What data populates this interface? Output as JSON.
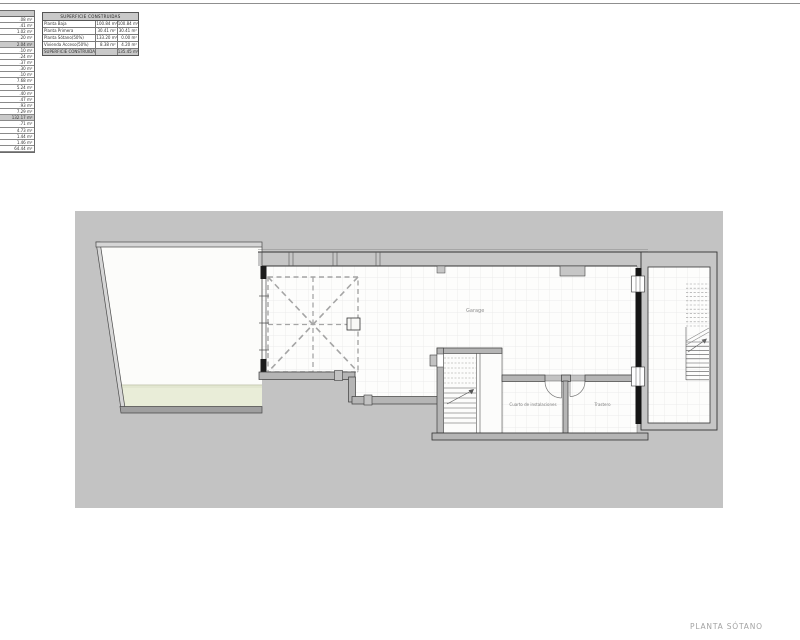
{
  "sheet": {
    "footer_title": "PLANTA SÓTANO"
  },
  "plan_labels": {
    "garage": "Garage",
    "installations_room": "Cuarto de instalaciones",
    "storage_room": "Trastero"
  },
  "colors": {
    "canvas_gray": "#c3c3c3",
    "wall_gray": "#b5b5b5",
    "floor_white": "#fdfdfc",
    "green_strip": "#e9edd8",
    "dashed_gray": "#a5a5a5",
    "black_wall": "#141414",
    "label_gray": "#8f8f8f",
    "footer_gray": "#a3a3a3"
  },
  "tables": {
    "superficie": {
      "header": "SUPERFICIE CONSTRUIDAS",
      "rows": [
        {
          "label": "Planta Baja",
          "col1": "100.84 m²",
          "col2": "100.84 m²",
          "highlight": false
        },
        {
          "label": "Planta Primera",
          "col1": "30.41 m²",
          "col2": "30.41 m²",
          "highlight": false
        },
        {
          "label": "Planta Sótano(50%)",
          "col1": "133.20 m²",
          "col2": "0.00 m²",
          "highlight": false
        },
        {
          "label": "Vivienda Acceso(50%)",
          "col1": "8.38 m²",
          "col2": "4.20 m²",
          "highlight": false
        },
        {
          "label": "SUPERFICIE CONSTRUIDA COMPUTABLE",
          "col1": "",
          "col2": "135.45 m²",
          "highlight": true
        }
      ]
    },
    "left_partial": {
      "rows": [
        {
          "value": ".08 m²",
          "highlight": false
        },
        {
          "value": ".41 m²",
          "highlight": false
        },
        {
          "value": "1.02 m²",
          "highlight": false
        },
        {
          "value": ".20 m²",
          "highlight": false
        },
        {
          "value": "2.04 m²",
          "highlight": true
        },
        {
          "value": ".10 m²",
          "highlight": false
        },
        {
          "value": ".24 m²",
          "highlight": false
        },
        {
          "value": ".37 m²",
          "highlight": false
        },
        {
          "value": ".30 m²",
          "highlight": false
        },
        {
          "value": ".10 m²",
          "highlight": false
        },
        {
          "value": "7.68 m²",
          "highlight": false
        },
        {
          "value": "5.24 m²",
          "highlight": false
        },
        {
          "value": ".40 m²",
          "highlight": false
        },
        {
          "value": ".47 m²",
          "highlight": false
        },
        {
          "value": ".93 m²",
          "highlight": false
        },
        {
          "value": "7.29 m²",
          "highlight": false
        },
        {
          "value": "132.17 m²",
          "highlight": true
        },
        {
          "value": ".71 m²",
          "highlight": false
        },
        {
          "value": "4.73 m²",
          "highlight": false
        },
        {
          "value": "1.44 m²",
          "highlight": false
        },
        {
          "value": "1.46 m²",
          "highlight": false
        },
        {
          "value": "64.44 m²",
          "highlight": false
        }
      ]
    }
  }
}
